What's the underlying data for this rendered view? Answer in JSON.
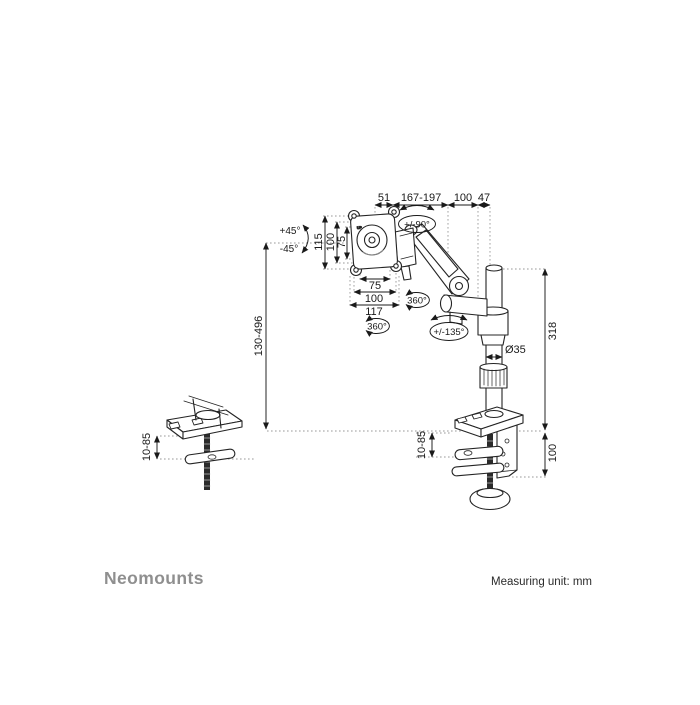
{
  "title": "Monitor desk mount dimension diagram",
  "footer": {
    "brand": "Neomounts",
    "measuring_unit": "Measuring unit: mm"
  },
  "colors": {
    "line": "#242424",
    "dotted": "#999999",
    "text": "#1a1a1a",
    "brand_gray": "#8f8f8f"
  },
  "dims": {
    "top_51": "51",
    "top_arm_reach": "167-197",
    "top_100": "100",
    "top_47": "47",
    "vesa_v_115": "115",
    "vesa_v_100": "100",
    "vesa_v_75": "75",
    "vesa_h_75": "75",
    "vesa_h_100": "100",
    "vesa_h_117": "117",
    "height_range": "130-496",
    "pole_height": "318",
    "pole_diameter": "Ø35",
    "grommet_thickness": "10-85",
    "clamp_thickness": "10-85",
    "clamp_depth": "100",
    "vesa_up_mark": "UP"
  },
  "angles": {
    "tilt_up": "+45°",
    "tilt_down": "-45°",
    "pivot": "+/-90°",
    "rotation_vesa": "360°",
    "rotation_elbow": "360°",
    "rotation_pole": "+/-135°"
  }
}
